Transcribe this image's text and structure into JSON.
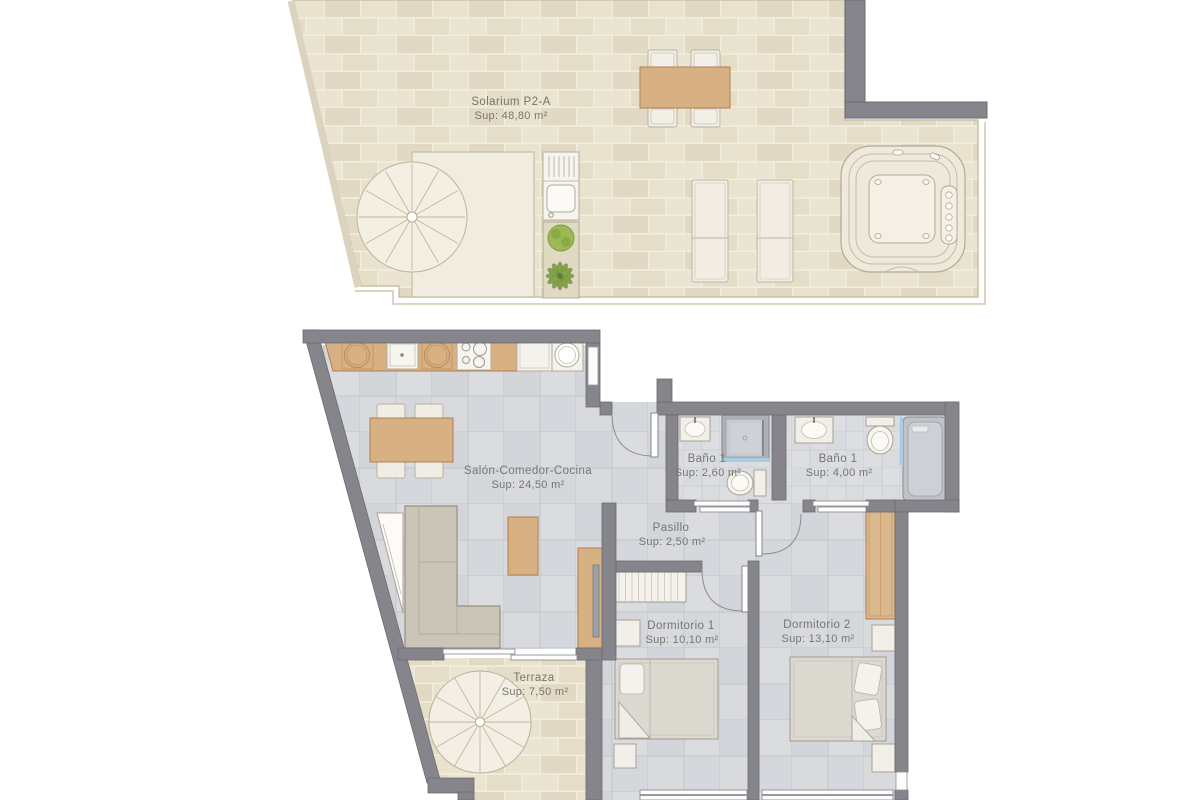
{
  "colors": {
    "wall_gray": "#85858b",
    "wood": "#d7b084",
    "tile_beige": "#e6dfca",
    "floor_gray": "#d7d9dd",
    "fixture_white": "#f2efe8",
    "glass_blue": "#a9cce3",
    "plant_green": "#8aa84e",
    "label_text": "#75766d"
  },
  "rooms": {
    "solarium": {
      "name": "Solarium P2-A",
      "area": "Sup: 48,80 m²"
    },
    "salon": {
      "name": "Salón-Comedor-Cocina",
      "area": "Sup: 24,50 m²"
    },
    "bano_small": {
      "name": "Baño 1",
      "area": "Sup: 2,60 m²"
    },
    "bano_big": {
      "name": "Baño 1",
      "area": "Sup: 4,00 m²"
    },
    "pasillo": {
      "name": "Pasillo",
      "area": "Sup: 2,50 m²"
    },
    "dormitorio1": {
      "name": "Dormitorio 1",
      "area": "Sup: 10,10 m²"
    },
    "dormitorio2": {
      "name": "Dormitorio 2",
      "area": "Sup: 13,10 m²"
    },
    "terraza": {
      "name": "Terraza",
      "area": "Sup: 7,50 m²"
    }
  }
}
